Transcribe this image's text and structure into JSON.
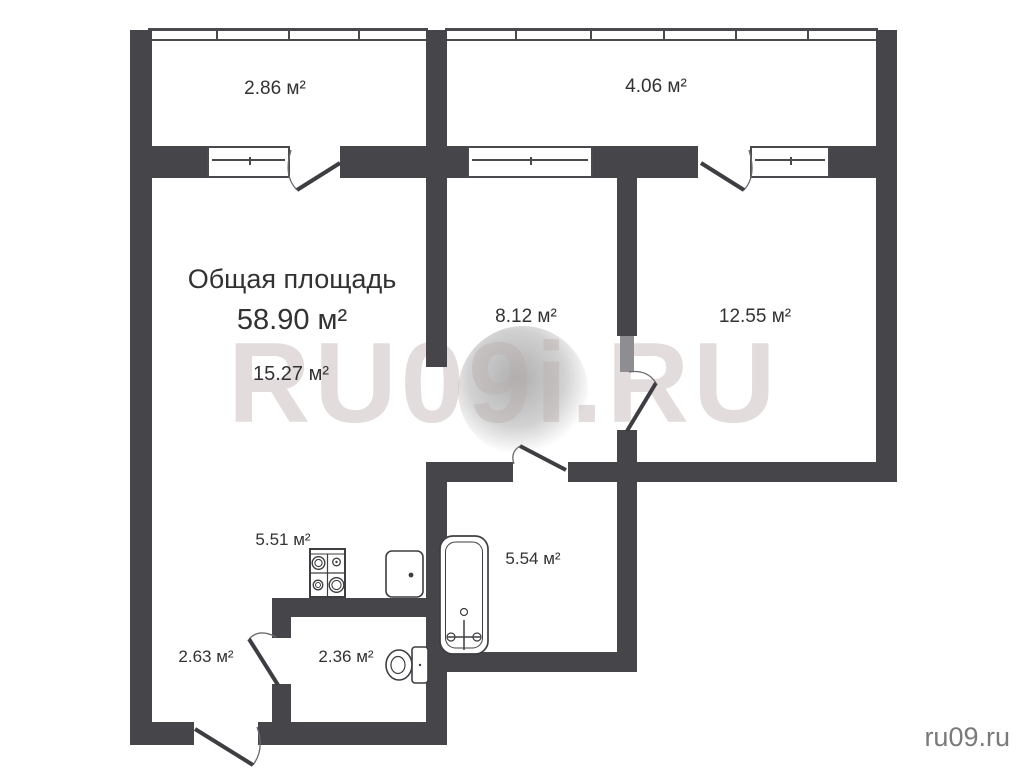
{
  "plan": {
    "title_label": "Общая площадь",
    "total_area": "58.90 м²",
    "rooms": [
      {
        "id": "balcony-left",
        "area": "2.86 м²"
      },
      {
        "id": "balcony-right",
        "area": "4.06 м²"
      },
      {
        "id": "living-room",
        "area": "15.27 м²"
      },
      {
        "id": "room-middle",
        "area": "8.12 м²"
      },
      {
        "id": "room-right",
        "area": "12.55 м²"
      },
      {
        "id": "kitchen",
        "area": "5.51 м²"
      },
      {
        "id": "bathroom",
        "area": "5.54 м²"
      },
      {
        "id": "hallway",
        "area": "2.63 м²"
      },
      {
        "id": "wc",
        "area": "2.36 м²"
      }
    ],
    "watermark": "RU09i.RU",
    "site_credit": "ru09.ru",
    "icons": {
      "stove": "stove-icon",
      "sink": "sink-icon",
      "bathtub": "bathtub-icon",
      "toilet": "toilet-icon"
    },
    "colors": {
      "wall": "#46464a",
      "line": "#4a4a4e",
      "label": "#323234",
      "watermark": "#d6c9c7",
      "credit": "#7a7a7c",
      "background": "#ffffff"
    }
  }
}
